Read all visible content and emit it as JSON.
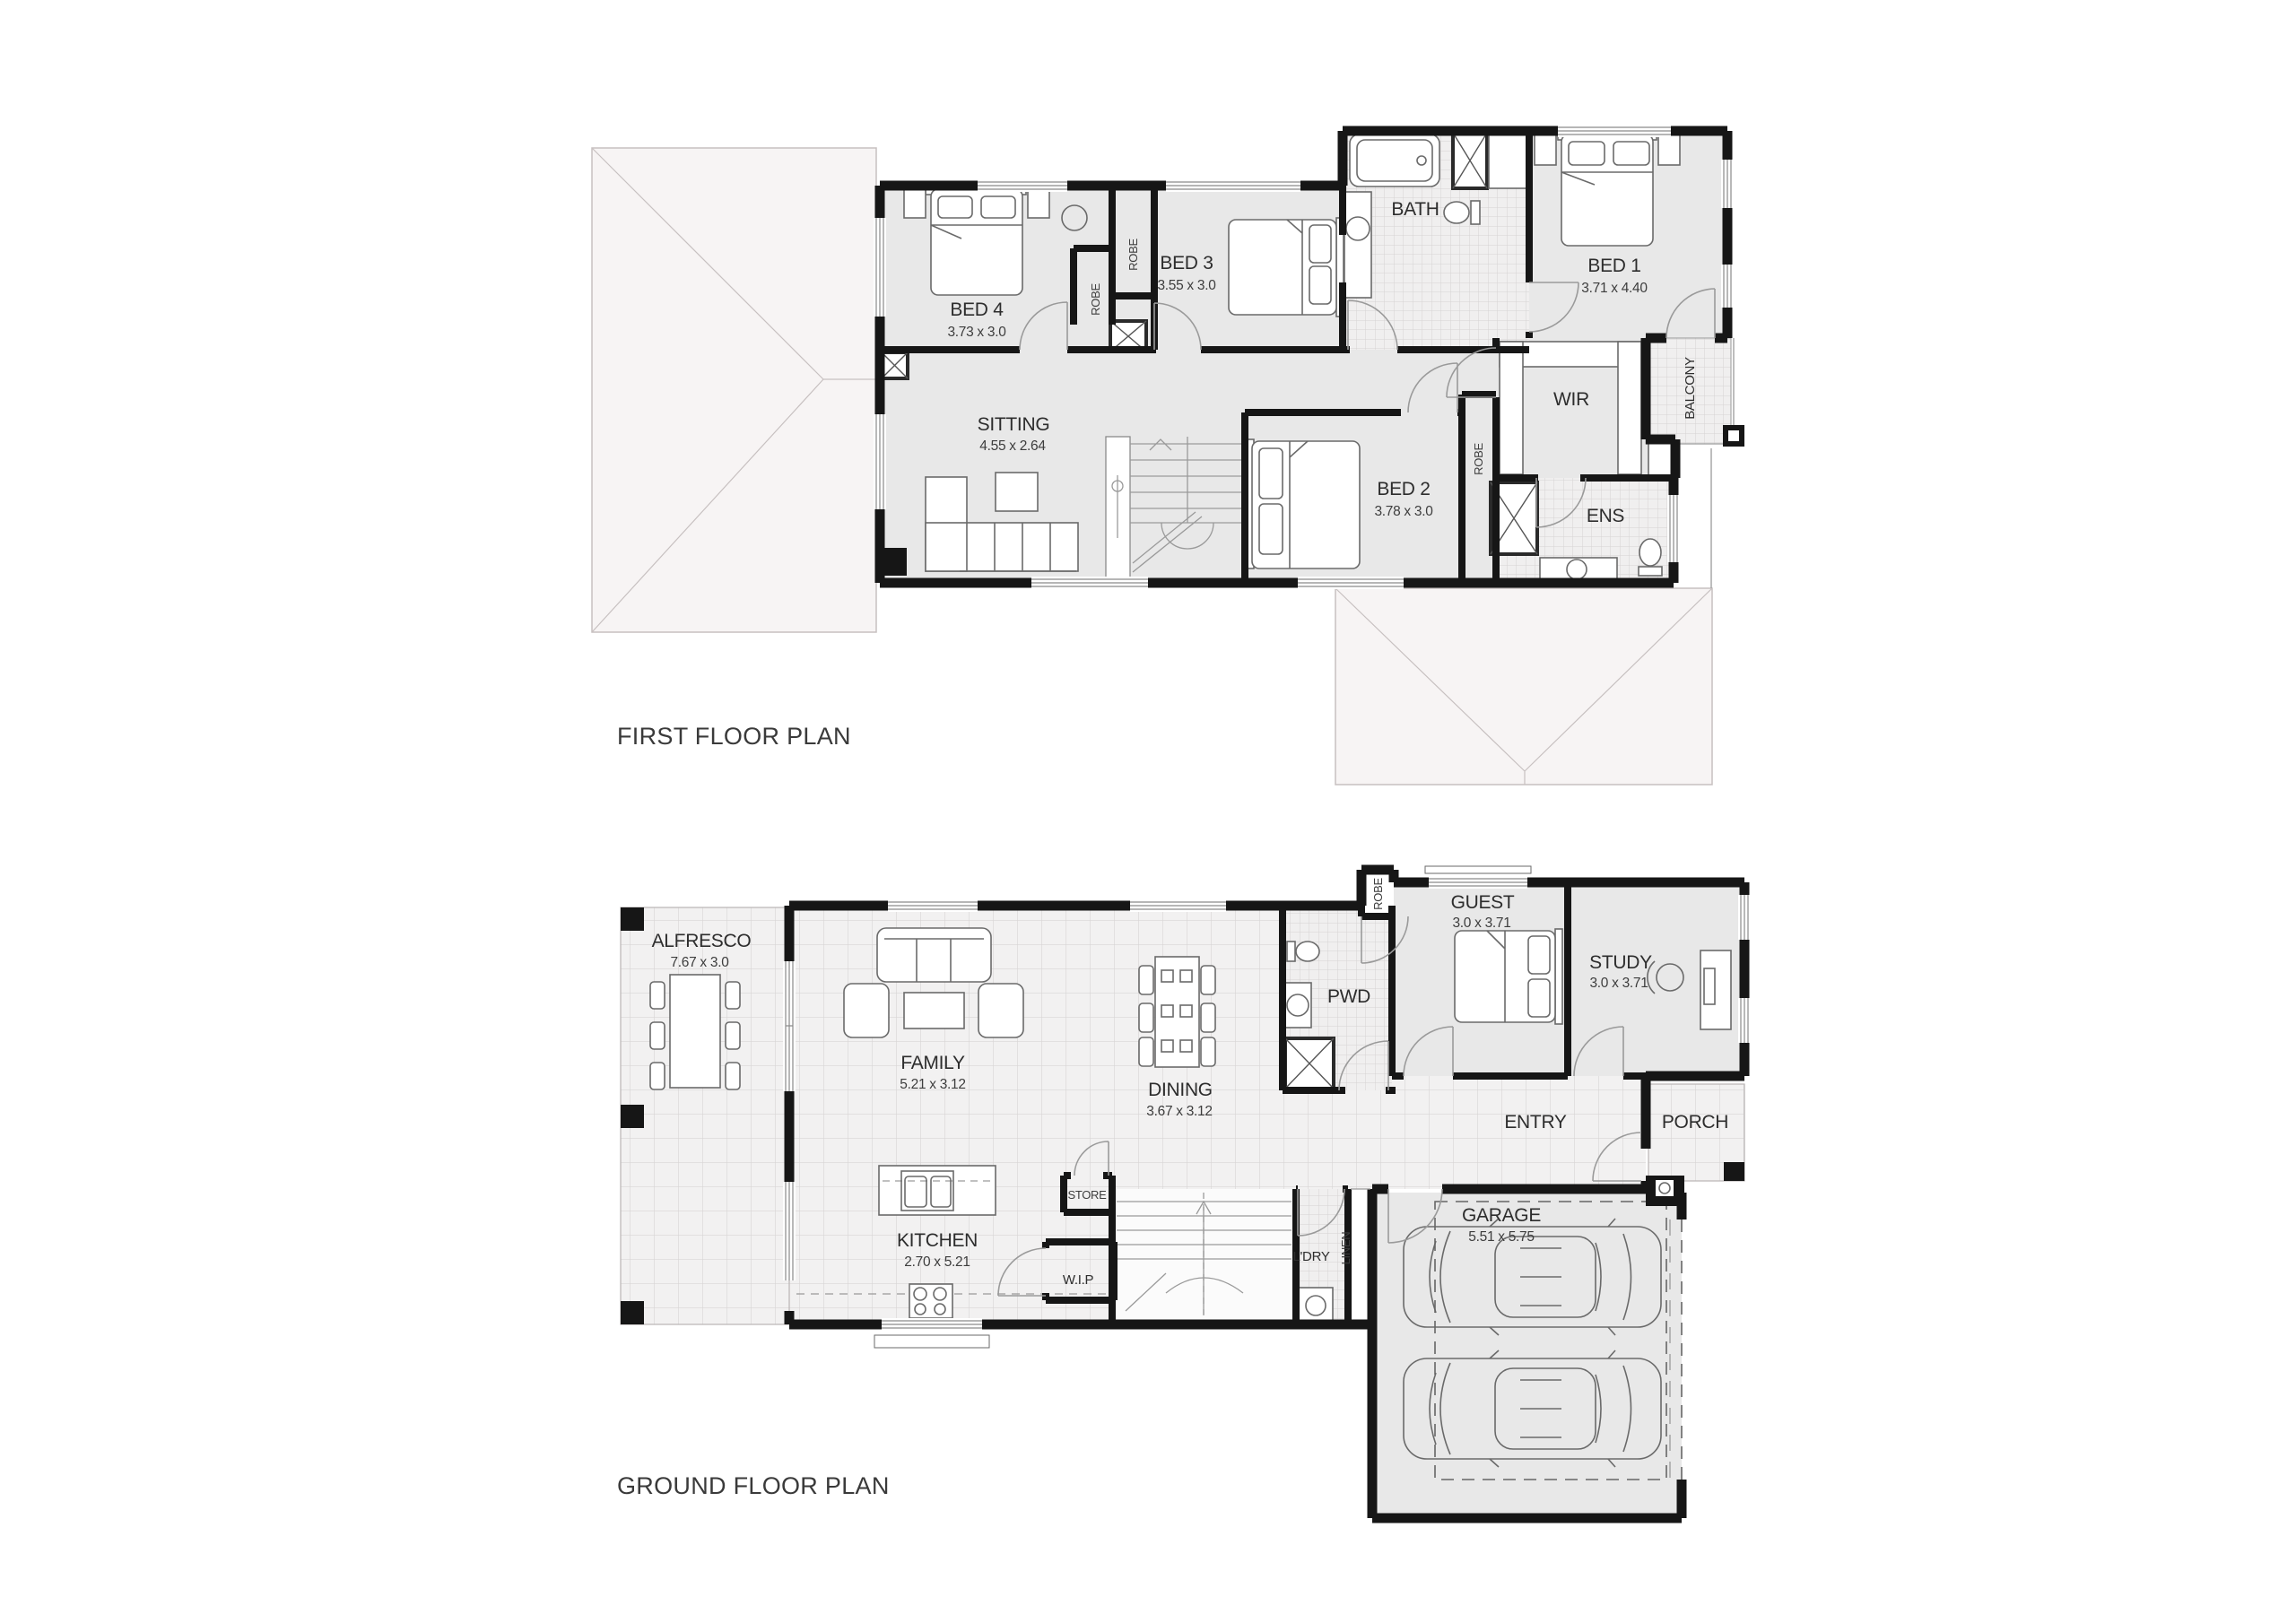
{
  "first_floor": {
    "title": "FIRST FLOOR PLAN",
    "rooms": {
      "bed4": {
        "label": "BED 4",
        "dims": "3.73 x 3.0"
      },
      "bed3": {
        "label": "BED 3",
        "dims": "3.55 x 3.0"
      },
      "bed1": {
        "label": "BED 1",
        "dims": "3.71 x 4.40"
      },
      "bed2": {
        "label": "BED 2",
        "dims": "3.78 x 3.0"
      },
      "sitting": {
        "label": "SITTING",
        "dims": "4.55 x 2.64"
      },
      "bath": {
        "label": "BATH"
      },
      "wir": {
        "label": "WIR"
      },
      "ens": {
        "label": "ENS"
      },
      "balcony": {
        "label": "BALCONY"
      },
      "robe_bed4": {
        "label": "ROBE"
      },
      "robe_bed3": {
        "label": "ROBE"
      },
      "robe_bed2": {
        "label": "ROBE"
      }
    }
  },
  "ground_floor": {
    "title": "GROUND FLOOR PLAN",
    "rooms": {
      "alfresco": {
        "label": "ALFRESCO",
        "dims": "7.67 x 3.0"
      },
      "family": {
        "label": "FAMILY",
        "dims": "5.21 x 3.12"
      },
      "dining": {
        "label": "DINING",
        "dims": "3.67 x 3.12"
      },
      "kitchen": {
        "label": "KITCHEN",
        "dims": "2.70 x 5.21"
      },
      "wip": {
        "label": "W.I.P"
      },
      "store": {
        "label": "STORE"
      },
      "pwd": {
        "label": "PWD"
      },
      "guest": {
        "label": "GUEST",
        "dims": "3.0 x 3.71"
      },
      "study": {
        "label": "STUDY",
        "dims": "3.0 x 3.71"
      },
      "entry": {
        "label": "ENTRY"
      },
      "porch": {
        "label": "PORCH"
      },
      "ldry": {
        "label": "L'DRY"
      },
      "linen": {
        "label": "LINEN"
      },
      "robe_guest": {
        "label": "ROBE"
      },
      "garage": {
        "label": "GARAGE",
        "dims": "5.51 x 5.75"
      }
    }
  },
  "colors": {
    "wall": "#161616",
    "carpet": "#e8e8e8",
    "roof": "#f7f4f4"
  }
}
